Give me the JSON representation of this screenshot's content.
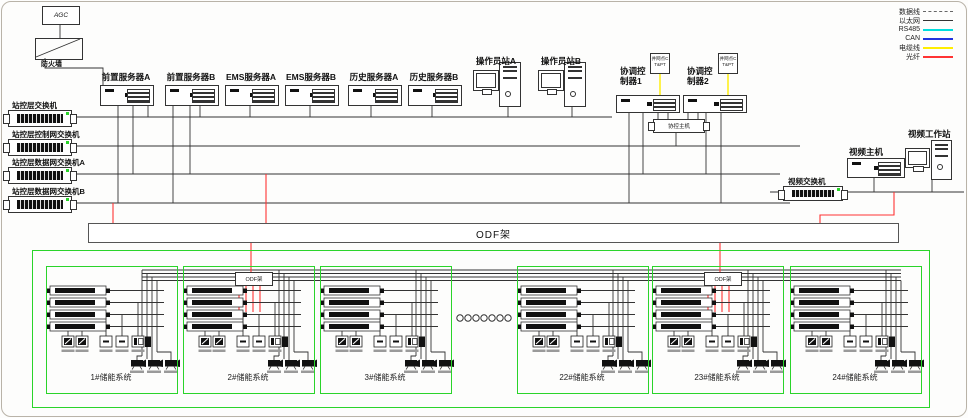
{
  "colors": {
    "green": "#2ad42a",
    "fiber_red": "#ff3333",
    "cable_yellow": "#ffee00",
    "rs485_cyan": "#00dddd",
    "can_blue": "#2233dd",
    "line_dark": "#333333"
  },
  "legend": {
    "items": [
      {
        "label": "数据线",
        "color": "#666666",
        "style": "dashed"
      },
      {
        "label": "以太网",
        "color": "#333333",
        "style": "solid"
      },
      {
        "label": "RS485",
        "color": "#00dddd",
        "style": "solid"
      },
      {
        "label": "CAN",
        "color": "#2233dd",
        "style": "solid"
      },
      {
        "label": "电缆线",
        "color": "#ffee00",
        "style": "solid"
      },
      {
        "label": "光纤",
        "color": "#ff3333",
        "style": "solid"
      }
    ]
  },
  "top": {
    "agc": "AGC",
    "firewall": "防火墙"
  },
  "servers": [
    "前置服务器A",
    "前置服务器B",
    "EMS服务器A",
    "EMS服务器B",
    "历史服务器A",
    "历史服务器B"
  ],
  "operators": [
    "操作员站A",
    "操作员站B"
  ],
  "controllers": {
    "c1": "协调控制器1",
    "c2": "协调控制器2",
    "host": "协控主机",
    "ct": "并网点CT&PT"
  },
  "station_switches": [
    "站控层交换机",
    "站控层控制网交换机",
    "站控层数据网交换机A",
    "站控层数据网交换机B"
  ],
  "video": {
    "workstation": "视频工作站",
    "host": "视频主机",
    "switch": "视频交换机"
  },
  "odf": {
    "label": "ODF架"
  },
  "systems": [
    {
      "label": "1#储能系统"
    },
    {
      "label": "2#储能系统",
      "odf_label": "ODF架"
    },
    {
      "label": "3#储能系统"
    },
    {
      "label": "22#储能系统"
    },
    {
      "label": "23#储能系统",
      "odf_label": "ODF架"
    },
    {
      "label": "24#储能系统"
    }
  ]
}
